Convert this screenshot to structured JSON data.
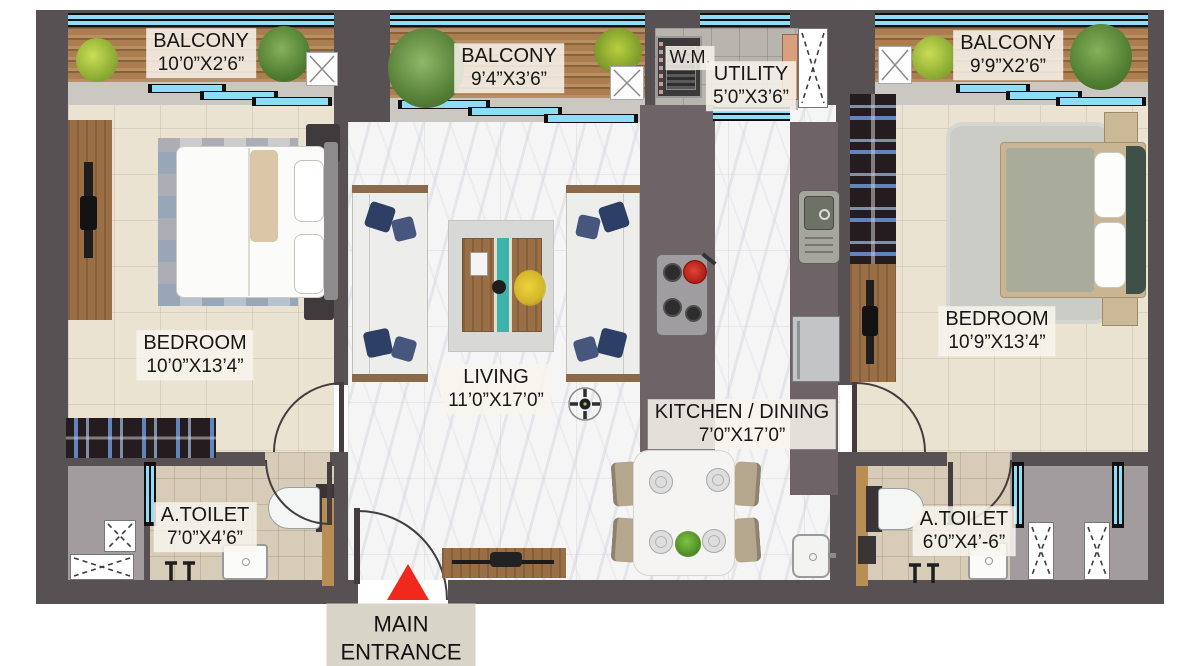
{
  "colors": {
    "wall": "#575153",
    "window_glass": "#8edcf6",
    "balcony_wood": "#ab7d4f",
    "bedroom_floor": "#ebe3d2",
    "marble_floor": "#f5f5f6",
    "toilet_floor": "#d7ccb8",
    "utility_floor": "#b8b4ae",
    "counter": "#6e6467",
    "entrance_marker_red": "#f0281d",
    "label_text": "#171717"
  },
  "labels": {
    "balcony_left": {
      "name": "BALCONY",
      "dims": "10’0”X2’6”"
    },
    "balcony_mid": {
      "name": "BALCONY",
      "dims": "9’4”X3’6”"
    },
    "balcony_right": {
      "name": "BALCONY",
      "dims": "9’9”X2’6”"
    },
    "wm": "W.M.",
    "utility": {
      "name": "UTILITY",
      "dims": "5’0”X3’6”"
    },
    "bedroom_left": {
      "name": "BEDROOM",
      "dims": "10’0”X13’4”"
    },
    "living": {
      "name": "LIVING",
      "dims": "11’0”X17’0”"
    },
    "kitchen_dining": {
      "name": "KITCHEN / DINING",
      "dims": "7’0”X17’0”"
    },
    "bedroom_right": {
      "name": "BEDROOM",
      "dims": "10’9”X13’4”"
    },
    "toilet_left": {
      "name": "A.TOILET",
      "dims": "7’0”X4’6”"
    },
    "toilet_right": {
      "name": "A.TOILET",
      "dims": "6’0”X4’-6”"
    },
    "main_entrance": "MAIN\nENTRANCE"
  }
}
